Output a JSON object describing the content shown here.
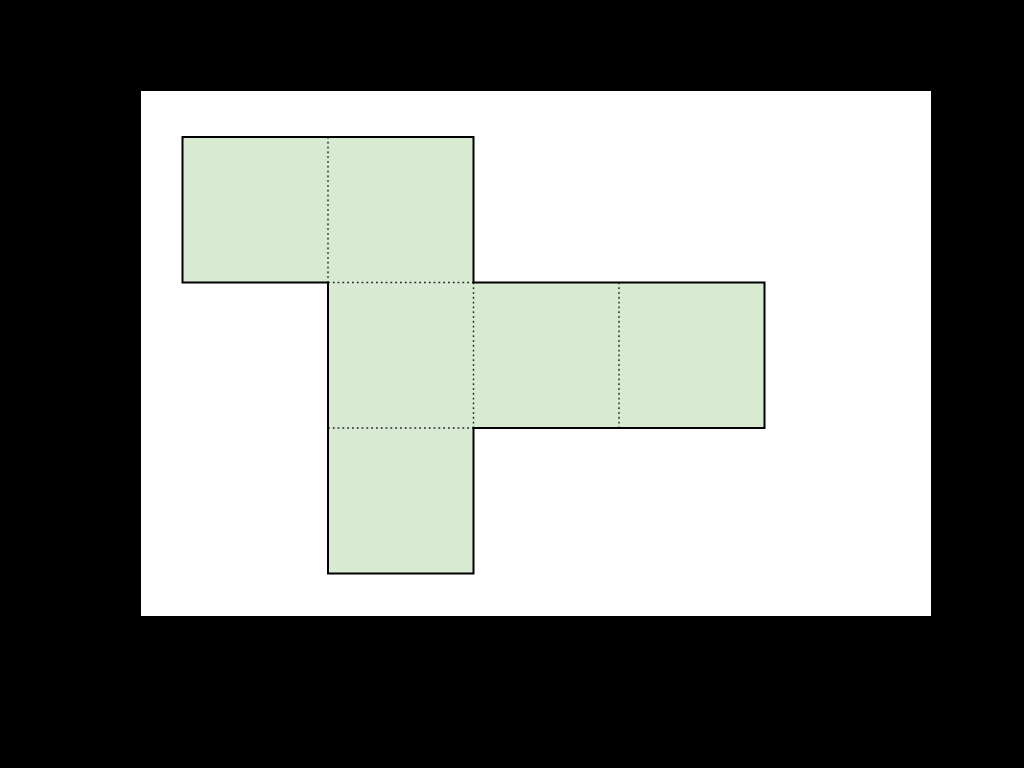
{
  "figure": {
    "page_background": "#000000",
    "canvas": {
      "left": 141,
      "top": 91,
      "width": 790,
      "height": 525,
      "background": "#ffffff"
    },
    "net": {
      "description": "cube-net-of-six-squares",
      "square_size": 145.5,
      "origin_x": 41.5,
      "origin_y": 46,
      "fill_color": "#d9ead3",
      "outline_color": "#000000",
      "outline_width": 2,
      "fold_color": "#222222",
      "fold_style": "dotted",
      "cells": [
        {
          "col": 0,
          "row": 0
        },
        {
          "col": 1,
          "row": 0
        },
        {
          "col": 1,
          "row": 1
        },
        {
          "col": 2,
          "row": 1
        },
        {
          "col": 3,
          "row": 1
        },
        {
          "col": 1,
          "row": 2
        }
      ]
    }
  }
}
